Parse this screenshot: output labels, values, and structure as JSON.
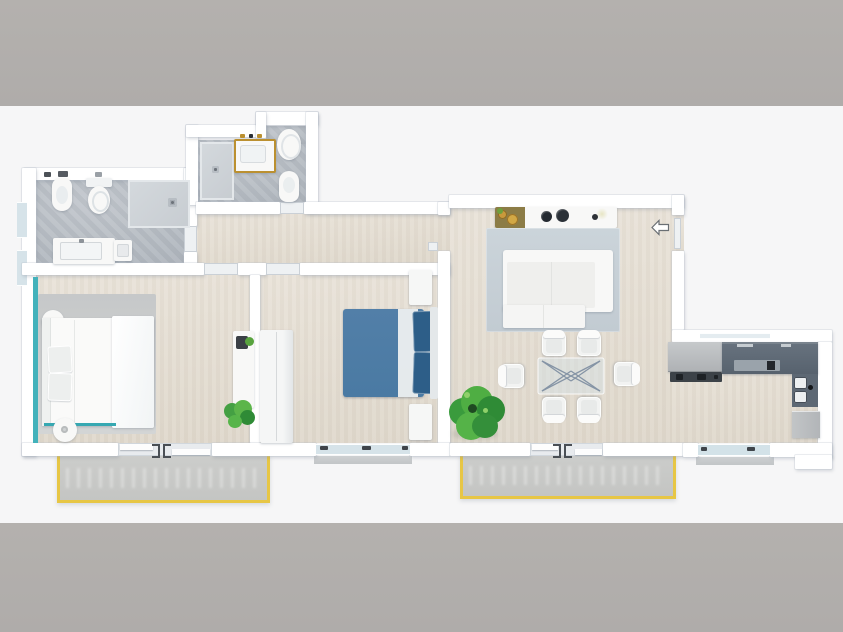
{
  "meta": {
    "image_type": "3d-apartment-floor-plan-top-view",
    "has_text": false,
    "frame": {
      "top_bar_height_px": 106,
      "bottom_bar_height_px": 109
    }
  },
  "colors": {
    "bar": "#b4b1ae",
    "canvas": "#f6f6f7",
    "wall": "#ffffff",
    "floor-wood": "#e5dfd4",
    "floor-concrete": "#b6bbc1",
    "shower-tray": "#ced3d8",
    "balcony-floor": "#c9cac8",
    "balcony-trim": "#e7c645",
    "teal": "#43b2bb",
    "bed-blue": "#4e80a8",
    "pillow-navy": "#2d5e88",
    "rug-living": "#c8d1d8",
    "rug-bedroom": "#cdd0d0",
    "kitchen-dark": "#5d6874",
    "kitchen-light": "#b9bcbf",
    "cooktop": "#3c4248",
    "gold": "#bb9030",
    "tray-olive": "#8c7c46",
    "plant-green": "#3f9d40",
    "glass-window": "#d6e3e9",
    "door-leaf": "#eef1f3",
    "handle-dark": "#4a4f55",
    "sill": "#c8cbcd",
    "white-furniture": "#f8f8f7"
  },
  "scene": {
    "rooms": [
      {
        "name": "bathroom-main",
        "objects": [
          "bidet",
          "toilet",
          "walk-in-shower",
          "vanity-sink",
          "side-unit",
          "wall-window",
          "wall-window"
        ]
      },
      {
        "name": "bathroom-second",
        "objects": [
          "walk-in-shower",
          "gold-framed-vanity-sink",
          "toilet",
          "bidet"
        ]
      },
      {
        "name": "hallway",
        "objects": [
          "door-to-bathroom-main",
          "door-to-bathroom-second",
          "door-to-bedroom-1",
          "door-to-bedroom-2",
          "door-to-living-room"
        ]
      },
      {
        "name": "bedroom-1",
        "objects": [
          "double-bed-white-teal-frame",
          "round-nightstand",
          "round-nightstand",
          "gray-area-rug",
          "desk-with-laptop",
          "potted-plant",
          "sliding-balcony-door",
          "teal-accent-wall"
        ]
      },
      {
        "name": "bedroom-2",
        "objects": [
          "double-bed-blue",
          "nightstand",
          "nightstand",
          "wardrobe",
          "window"
        ]
      },
      {
        "name": "living-dining-room",
        "objects": [
          "sideboard-with-decor",
          "blue-gray-area-rug",
          "white-corner-sofa",
          "glass-dining-table",
          "dining-chair",
          "dining-chair",
          "dining-chair",
          "dining-chair",
          "dining-chair",
          "dining-chair",
          "potted-tree",
          "entrance-door-with-arrow",
          "sliding-balcony-door"
        ]
      },
      {
        "name": "kitchen-nook",
        "objects": [
          "tall-appliance-column",
          "cooktop",
          "l-shaped-dark-counter",
          "double-sink",
          "base-cabinet",
          "window"
        ]
      },
      {
        "name": "balcony-left",
        "objects": [
          "yellow-trim"
        ]
      },
      {
        "name": "balcony-center",
        "objects": [
          "yellow-trim"
        ]
      }
    ],
    "dining_chairs_count": 6,
    "entrance_arrow_direction": "left"
  }
}
